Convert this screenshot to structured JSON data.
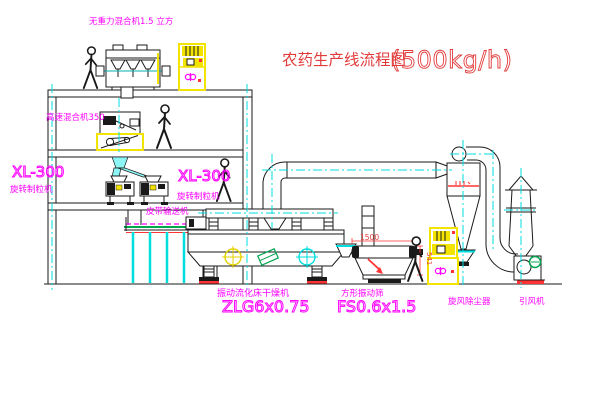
{
  "diagram": {
    "title": "农药生产线流程图",
    "capacity": "(500kg/h)"
  },
  "labels": {
    "no_gravity_mixer": "无重力混合机1.5 立方",
    "high_speed_mixer": "高速混合机350",
    "granulator_left_model": "XL-300",
    "granulator_left_name": "旋转制粒机",
    "granulator_right_model": "XL-300",
    "granulator_right_name": "旋转制粒机",
    "belt_conveyor": "皮带输送机",
    "dryer_name": "振动流化床干燥机",
    "dryer_model": "ZLG6x0.75",
    "sieve_name": "方形振动筛",
    "sieve_model": "FS0.6x1.5",
    "cyclone": "旋风除尘器",
    "fan": "引风机"
  },
  "dimensions": {
    "sieve_length": "1500",
    "sieve_outlet_height": "541"
  },
  "colors": {
    "line": "#1a1a1a",
    "label_magenta": "#ff00ff",
    "title_red": "#e23b3b",
    "centerline_cyan": "#00dede",
    "highlight_yellow": "#f3e300",
    "accent_green": "#00a54f",
    "accent_red": "#ff3333"
  }
}
